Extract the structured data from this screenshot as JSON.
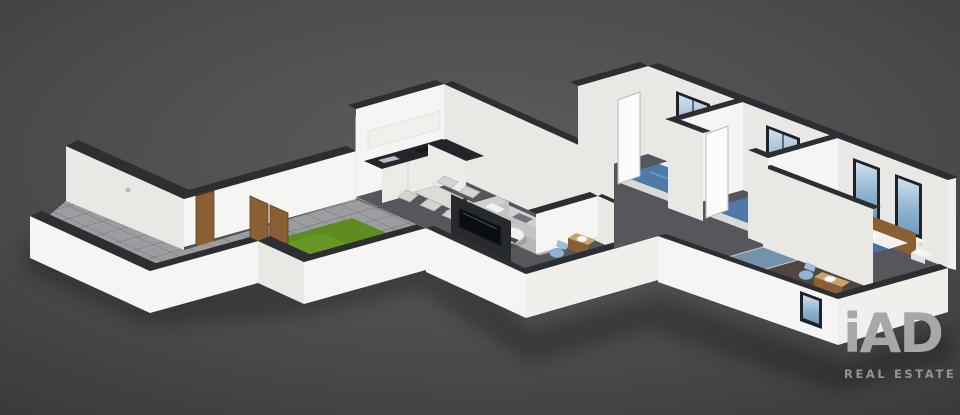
{
  "logo": {
    "brand": "iAD",
    "tagline": "REAL ESTATE"
  },
  "scene": {
    "type": "isometric-3d-floorplan-render",
    "rooms": [
      "terrace",
      "garden-lawn",
      "kitchen",
      "dining-area",
      "living-room",
      "guest-bathroom",
      "hallway",
      "bedroom-1",
      "bedroom-2",
      "master-bedroom",
      "master-bathroom"
    ]
  },
  "colors": {
    "bg_center": "#5b5c5e",
    "bg_edge": "#3a3b3d",
    "wall": "#f6f5f3",
    "wall_shaded": "#e9e8e5",
    "wall_end": "#f0efec",
    "wall_cap": "#2c2e31",
    "floor": "#55575c",
    "tile": "#9c9da0",
    "tile_line": "#727376",
    "grass": "#5f8c1f",
    "grass_light": "#79a62e",
    "glass_frame": "#1f2226",
    "wood": "#8a5f33",
    "wood_light": "#a97c48",
    "counter": "#22252a",
    "cabinet": "#ecebe8",
    "sofa": "#d0d1cf",
    "sofa_dark": "#c3c4c2",
    "rug": "#b6b7b5",
    "bed_blue": "#4e7aa8",
    "bed_white": "#f1f1ef",
    "fixture_blue": "#8fb4d4",
    "bath_floor": "#4f463d",
    "logo": "#a6a7a9",
    "tagline": "#939496"
  }
}
